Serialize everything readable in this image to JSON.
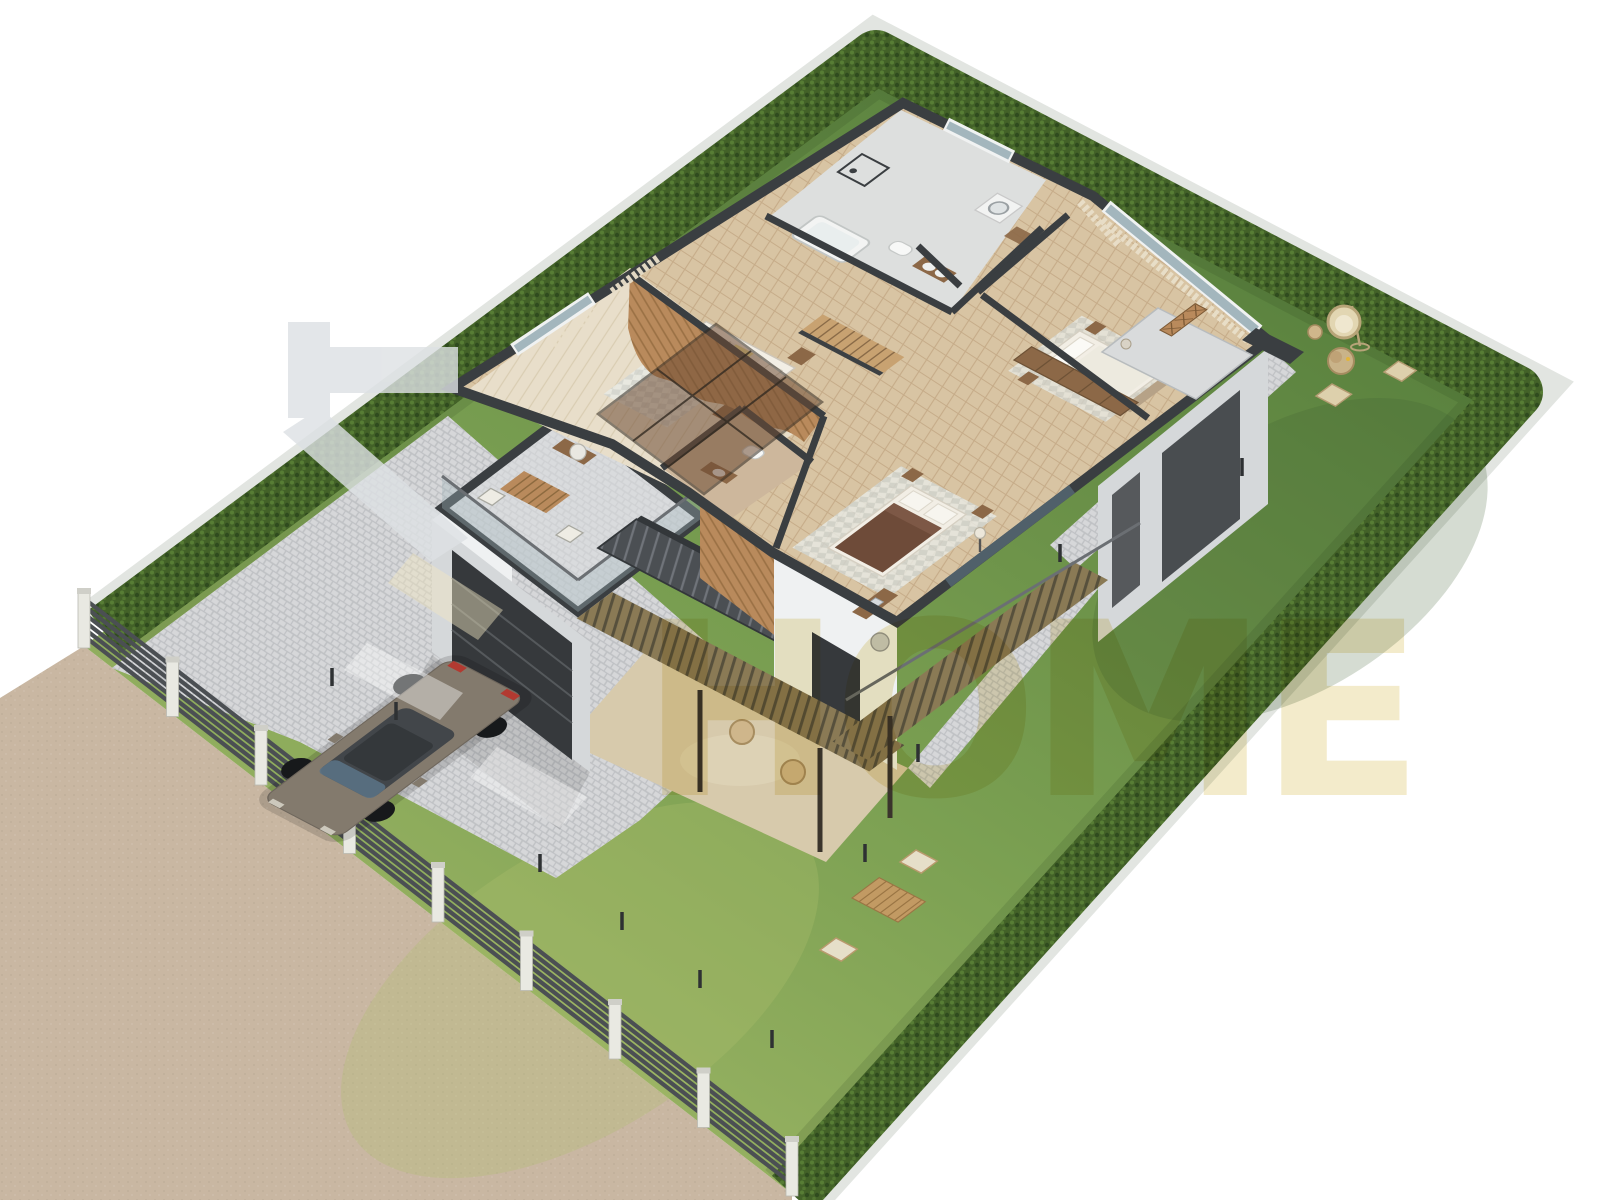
{
  "watermark": {
    "text": "HOME",
    "logo_shape": "sideways-T-with-diagonal-slash",
    "text_color": "#f1e7c0",
    "logo_color": "#dde1e4"
  },
  "scene": {
    "type": "3d-isometric-cutaway-floor-plan-render",
    "view": "aerial isometric, roof removed to show upper floor",
    "background": "#ffffff",
    "palette": {
      "bg": "#ffffff",
      "road": "#c9b7a2",
      "grass-light": "#a3b968",
      "grass-mid": "#7ba052",
      "grass-deep": "#567e3c",
      "hedge": "#436228",
      "hedge-hi": "#5d8338",
      "hedge-lo": "#2c461c",
      "fence": "#4b4f53",
      "post": "#e9e9e2",
      "paver": "#d6d7d9",
      "paver-joint": "#bfc1c4",
      "stone": "#d7caac",
      "wall": "#eff1f2",
      "wall-shade": "#d5d8da",
      "cap": "#3a3e41",
      "door": "#36393c",
      "glass": "#a3b6bd",
      "glass-dark": "#50606a",
      "glass-brown": "#6e4c34",
      "wood": "#b98a5c",
      "wood-dark": "#8c6847",
      "floor-parquet": "#d8c4a3",
      "floor-light": "#e8deca",
      "tile": "#cdb79c",
      "marble": "#dddfde",
      "curtain": "#e9dfc9",
      "car": "#837a6d",
      "car-glass": "#42464a",
      "taillight": "#b23a31",
      "rug": "#d1d5d1",
      "bed-white": "#f2eee5",
      "bed-brown": "#6e4b39",
      "blanket": "#e9db93",
      "rattan": "#cfb68b",
      "watermark": "#f1e7c0",
      "logo": "#dde1e4",
      "step": "#4b4f53"
    },
    "site": {
      "road": "gravel road along the south-west side",
      "fence": {
        "style": "horizontal dark metal slats with white concrete posts",
        "slats": 6,
        "posts": 9
      },
      "hedge_sides": [
        "northwest",
        "northeast",
        "southeast"
      ],
      "lawns": [
        "front lawn with bollard lights",
        "right side garden",
        "back garden"
      ],
      "driveway": "grey paver driveway with parked sedan",
      "bollard_lights": 10
    },
    "house": {
      "style": "modern flat-roof villa, upper floor cutaway",
      "garage": {
        "door": "dark sectional door",
        "roof_terrace": [
          "wood slat table",
          "2 folding chairs",
          "glass railing"
        ]
      },
      "entrance_canopy": "bronze glass panel canopy",
      "exterior_stair": "dark steel staircase along south-west facade",
      "covered_patio": [
        "stone floor",
        "slatted canopy",
        "support posts",
        "2 wicker stools"
      ],
      "balconies": [
        "master bedroom corner balcony with x-pattern planter",
        "rear balcony above patio"
      ],
      "rooms": [
        {
          "name": "bedroom-left",
          "floor": "light oak",
          "items": [
            "single bed with striped bedding and yellow throw",
            "wavy wood-slat accent wall",
            "2 nightstands",
            "desk with chair",
            "geometric rug",
            "curtained window"
          ]
        },
        {
          "name": "ensuite-wc",
          "floor": "beige tile",
          "items": [
            "toilet",
            "wood vanity with basin"
          ]
        },
        {
          "name": "family-bathroom",
          "floor": "grey marble",
          "items": [
            "bathtub",
            "walk-in shower",
            "toilet",
            "wood vanity"
          ]
        },
        {
          "name": "laundry-nook",
          "items": [
            "stacked washer and dryer",
            "wood shelving"
          ]
        },
        {
          "name": "hallway-landing",
          "floor": "herringbone parquet",
          "items": [
            "internal staircase",
            "window to hedge"
          ]
        },
        {
          "name": "master-bedroom",
          "floor": "herringbone parquet",
          "items": [
            "double bed with white bedding",
            "bench",
            "2 nightstands",
            "rug",
            "curtains",
            "balcony access"
          ]
        },
        {
          "name": "wardrobe-corridor",
          "items": [
            "row of wooden wardrobes"
          ]
        },
        {
          "name": "bedroom-rear",
          "floor": "herringbone parquet",
          "items": [
            "double bed with brown duvet",
            "2 nightstands",
            "desk with laptop",
            "desk chair",
            "floor lamp",
            "grey rug",
            "sliding glass wall to balcony"
          ]
        }
      ]
    },
    "garden_furniture": {
      "right_garden": [
        "hanging egg chair",
        "rattan drum side table",
        "round coffee table with sun hat",
        "wicker chair",
        "wicker lounge chair"
      ],
      "back_garden": [
        "wooden slat table",
        "2 folding chairs"
      ]
    },
    "vehicle": {
      "type": "sedan",
      "color": "#837a6d",
      "location": "paver driveway in front of garage"
    }
  }
}
